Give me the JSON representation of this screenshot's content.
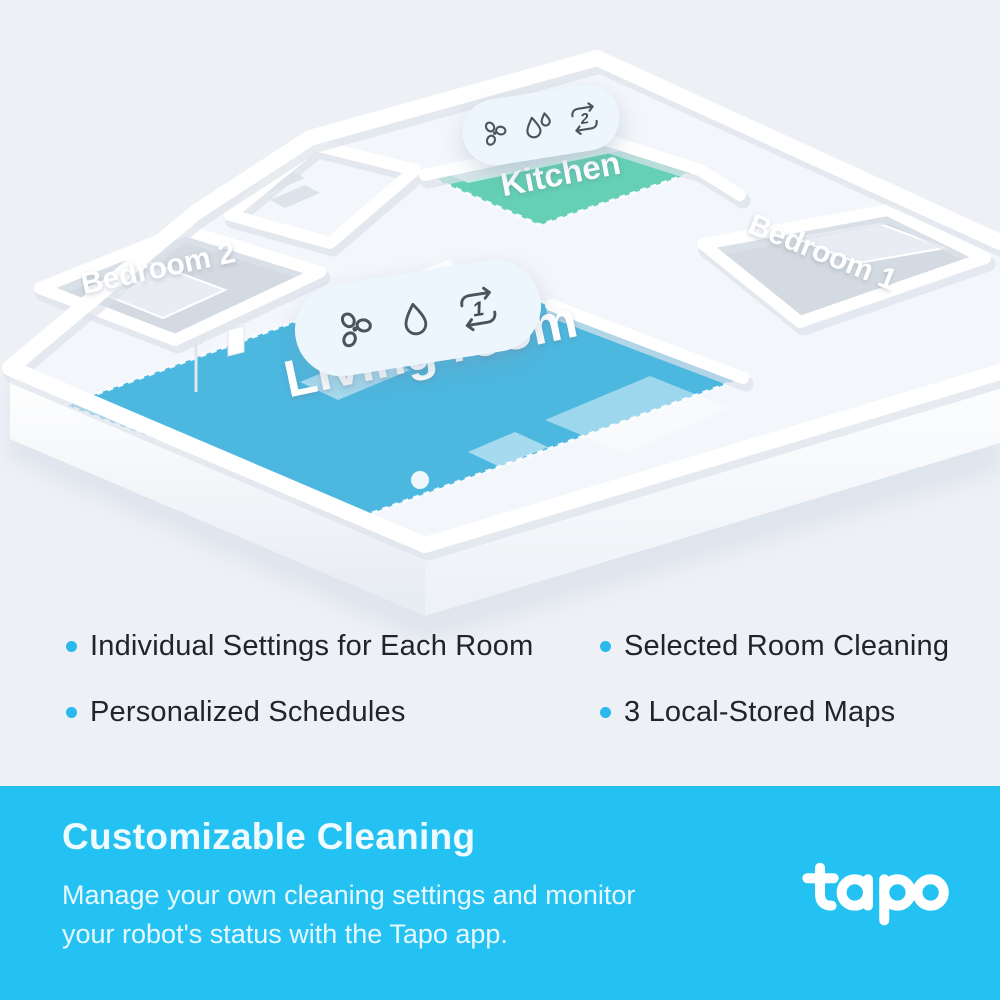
{
  "floorplan": {
    "rooms": [
      {
        "id": "living-room",
        "label": "Living room",
        "floor_color": "#41b2dd"
      },
      {
        "id": "kitchen",
        "label": "Kitchen",
        "floor_color": "#5bcdb0"
      },
      {
        "id": "bedroom-1",
        "label": "Bedroom 1",
        "floor_color": "#cdd3dc"
      },
      {
        "id": "bedroom-2",
        "label": "Bedroom 2",
        "floor_color": "#cdd3dc"
      }
    ],
    "badges": [
      {
        "room": "kitchen",
        "icons": [
          "fan-icon",
          "two-water-drops-icon",
          "cleaning-cycles-icon"
        ],
        "cycle_count": "2"
      },
      {
        "room": "living-room",
        "icons": [
          "fan-icon",
          "water-drop-icon",
          "cleaning-cycles-icon"
        ],
        "cycle_count": "1"
      }
    ]
  },
  "features": {
    "bullet_color": "#2ab9ee",
    "left": [
      "Individual Settings for Each Room",
      "Personalized Schedules"
    ],
    "right": [
      "Selected Room Cleaning",
      "3 Local-Stored Maps"
    ]
  },
  "banner": {
    "background": "#23c2f2",
    "title": "Customizable Cleaning",
    "description_line1": "Manage your own cleaning settings and monitor",
    "description_line2": "your robot's status with the Tapo app.",
    "brand": "tapo"
  }
}
